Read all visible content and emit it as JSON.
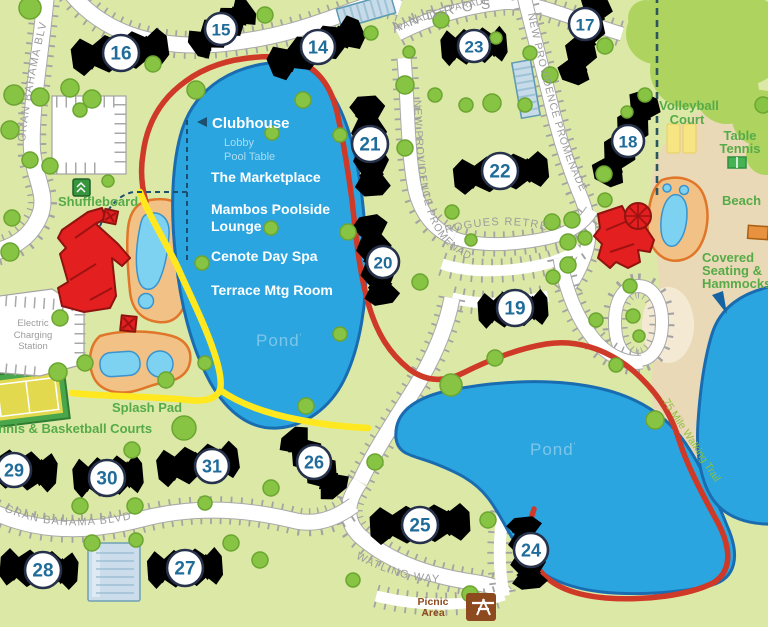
{
  "streets": {
    "andros": "ANDROS",
    "gran_bahama_top": "GRAN BAHAMA BLVD",
    "paradise_parade": "PARADISE PARADE",
    "new_providence_1": "NEW PROVIDENCE PROMENADE",
    "new_providence_2": "NEW PROVIDENCE PROMENADE",
    "rogues_retreat": "ROGUES RETREAT",
    "watling_way": "WATLING WAY",
    "gran_bahama_bottom": "GRAN BAHAMA BLVD",
    "walking_trail": ".75 Mile Walking Trail"
  },
  "ponds": {
    "pond1": "Pond",
    "pond2": "Pond",
    "mark": "'"
  },
  "callouts": {
    "clubhouse": "Clubhouse",
    "lobby": "Lobby",
    "pool_table": "Pool Table",
    "marketplace": "The Marketplace",
    "mambos_line1": "Mambos Poolside",
    "mambos_line2": "Lounge",
    "cenote": "Cenote Day Spa",
    "terrace": "Terrace Mtg Room"
  },
  "amenities": {
    "shuffleboard": "Shuffleboard",
    "splash_pad": "Splash Pad",
    "tennis_basketball": "Tennis & Basketball Courts",
    "electric_line1": "Electric",
    "electric_line2": "Charging",
    "electric_line3": "Station",
    "volleyball_line1": "Volleyball",
    "volleyball_line2": "Court",
    "table_tennis_line1": "Table",
    "table_tennis_line2": "Tennis",
    "beach": "Beach",
    "covered_line1": "Covered",
    "covered_line2": "Seating &",
    "covered_line3": "Hammocks",
    "picnic_line1": "Picnic",
    "picnic_line2": "Area"
  },
  "buildings": {
    "b14": "14",
    "b15": "15",
    "b16": "16",
    "b17": "17",
    "b18": "18",
    "b19": "19",
    "b20": "20",
    "b21": "21",
    "b22": "22",
    "b23": "23",
    "b24": "24",
    "b25": "25",
    "b26": "26",
    "b27": "27",
    "b28": "28",
    "b29": "29",
    "b30": "30",
    "b31": "31"
  },
  "colors": {
    "grass": "#dce8a6",
    "pond": "#2aa5e0",
    "pond_outline": "#1a6cb0",
    "trail_red": "#cf3a28",
    "path_yellow": "#ffe81f",
    "building_orange": "#e88f3e",
    "building_green": "#2d9b4e",
    "building_red": "#e31f1f",
    "beach_sand": "#ead9b6",
    "road": "#ffffff",
    "marker_number": "#1f6b99"
  }
}
